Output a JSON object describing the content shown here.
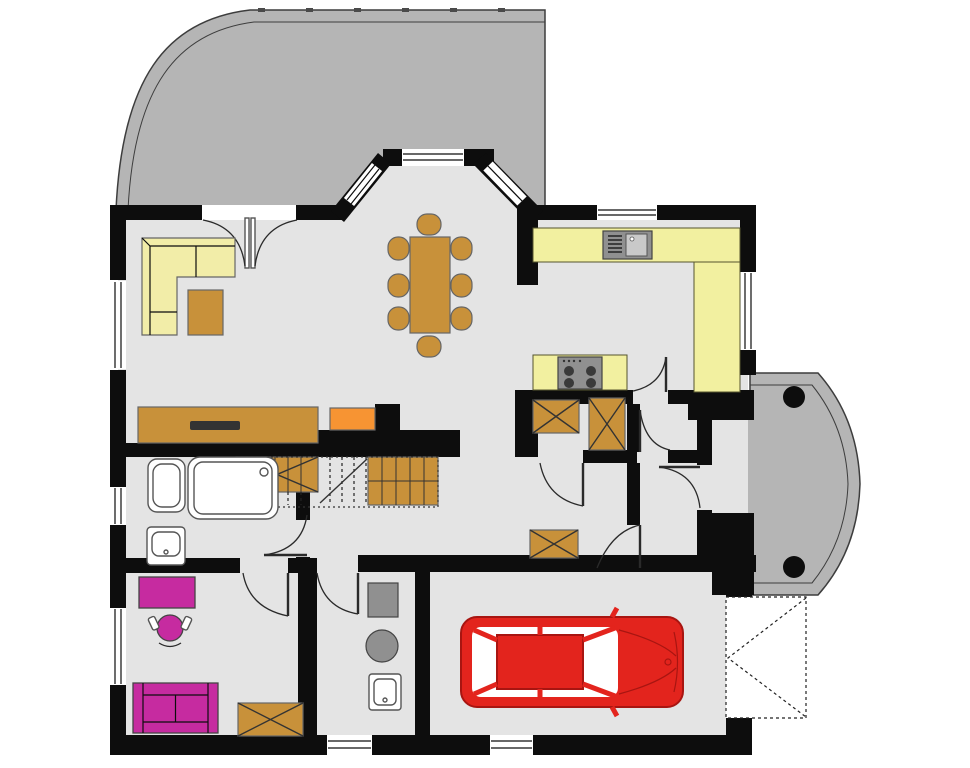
{
  "colors": {
    "wall": "#0d0d0d",
    "floor": "#e4e4e4",
    "terrace": "#b5b5b5",
    "outline": "#3d3d3d",
    "counter": "#f2f0a0",
    "sofa_yellow": "#f2eda8",
    "wood": "#c8913a",
    "orange": "#f79433",
    "magenta": "#c62ba0",
    "car": "#e3241d",
    "car_dark": "#a81511",
    "appliance": "#909090"
  },
  "inventory": {
    "outdoor": [
      "terrace",
      "entrance-porch",
      "porch-columns",
      "driveway-apron"
    ],
    "rooms": [
      "living-room",
      "dining-area",
      "kitchen",
      "hallway",
      "bathroom",
      "office",
      "utility-room",
      "garage",
      "entry-vestibule",
      "storage-room"
    ],
    "living_room": [
      "corner-sofa",
      "armchair-table",
      "sideboard",
      "tv",
      "orange-cabinet"
    ],
    "dining_area": [
      "dining-table",
      "dining-chairs-x8"
    ],
    "kitchen": [
      "l-shaped-counter",
      "sink-unit",
      "stove-counter",
      "stove-4-burners"
    ],
    "hall": [
      "staircase",
      "wardrobe-1",
      "wardrobe-2",
      "wardrobe-3"
    ],
    "bathroom": [
      "toilet",
      "shower",
      "washbasin"
    ],
    "office": [
      "desk",
      "office-chair",
      "two-seat-sofa",
      "wardrobe-4"
    ],
    "utility_room": [
      "washing-machine",
      "boiler",
      "utility-sink"
    ],
    "garage": [
      "red-car",
      "garage-door-opening"
    ],
    "openings": [
      "french-door",
      "bay-windows-x3",
      "entry-door",
      "interior-doors-x8",
      "windows-x8"
    ]
  }
}
